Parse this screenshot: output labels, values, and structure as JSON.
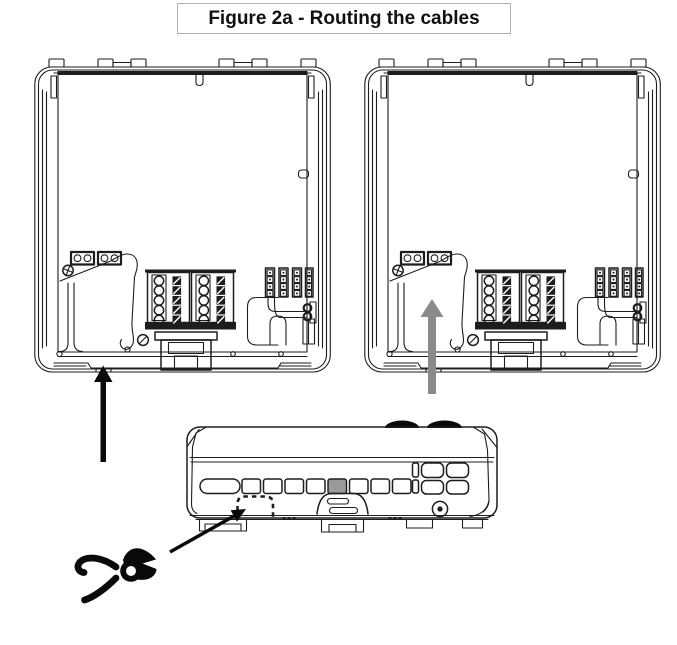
{
  "figure": {
    "title": "Figure 2a - Routing the cables"
  },
  "colors": {
    "line": "#1d1d1d",
    "background": "#ffffff",
    "arrow-black": "#0a0a0a",
    "arrow-gray": "#8a8a8a",
    "knockout-slot-fill": "#9a9a9a",
    "title-border": "#b0b0b0"
  },
  "icons": {
    "left_arrow": "up-arrow-black-icon",
    "right_arrow": "up-arrow-gray-icon",
    "cutter": "wire-cutter-pliers-icon",
    "knockout_outline": "dashed-knockout-outline",
    "pointer": "knockout-pointer-arrow-icon"
  }
}
